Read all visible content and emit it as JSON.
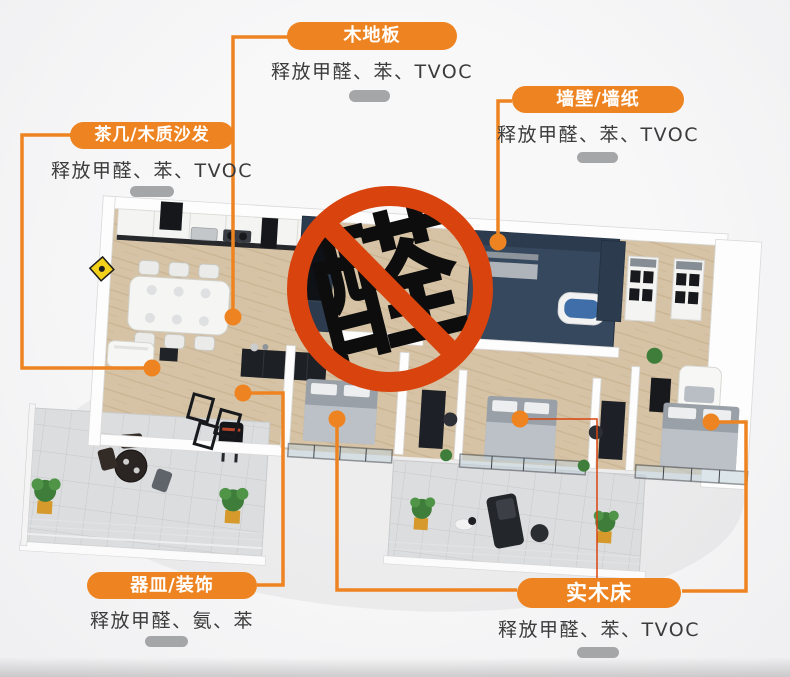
{
  "colors": {
    "accent_orange": "#ee8421",
    "ban_red": "#d9440e",
    "decor_gray": "#a5a6a8",
    "text_dark": "#3b3b3b",
    "navy_wall": "#2c3b4e",
    "wood_floor": "#d6c3a5"
  },
  "labels": [
    {
      "id": "wood-floor",
      "title": "木地板",
      "desc": "释放甲醛、苯、TVOC"
    },
    {
      "id": "wall-wallpaper",
      "title": "墙壁/墙纸",
      "desc": "释放甲醛、苯、TVOC"
    },
    {
      "id": "tea-table-wood-sofa",
      "title": "茶几/木质沙发",
      "desc": "释放甲醛、苯、TVOC"
    },
    {
      "id": "vessel-decoration",
      "title": "器皿/装饰",
      "desc": "释放甲醛、氨、苯"
    },
    {
      "id": "solid-wood-bed",
      "title": "实木床",
      "desc": "释放甲醛、苯、TVOC"
    }
  ],
  "center_mark": {
    "character": "醛"
  }
}
